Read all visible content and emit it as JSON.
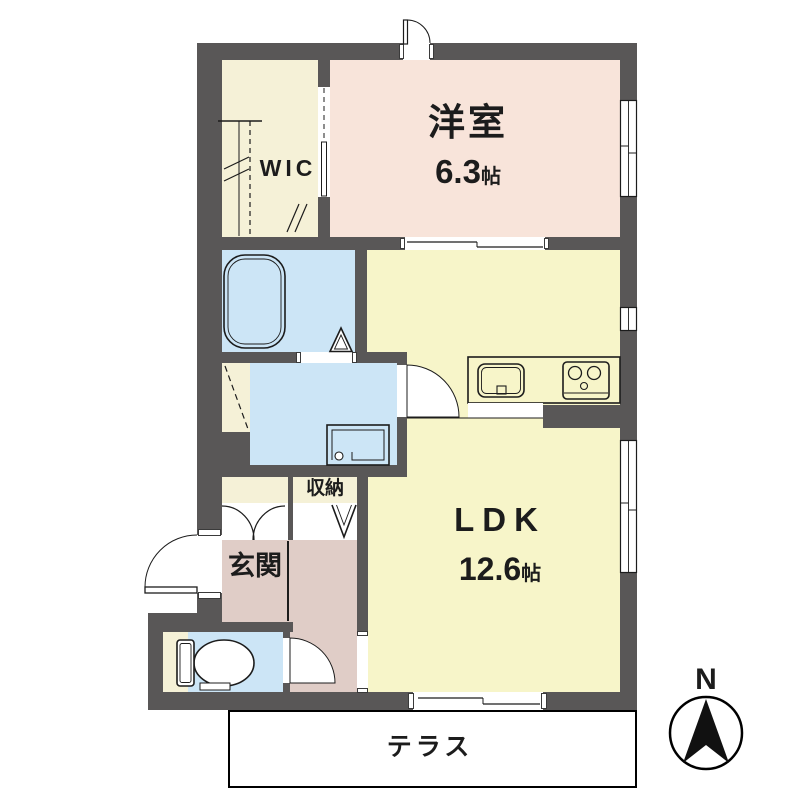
{
  "floorplan": {
    "compass": {
      "label": "N"
    },
    "rooms": {
      "western_room": {
        "name": "洋室",
        "size_value": "6.3",
        "size_unit": "帖"
      },
      "ldk": {
        "name": "LDK",
        "size_value": "12.6",
        "size_unit": "帖"
      },
      "wic": {
        "name": "WIC"
      },
      "entrance": {
        "name": "玄関"
      },
      "storage": {
        "name": "収納"
      },
      "terrace": {
        "name": "テラス"
      }
    },
    "colors": {
      "wall": "#595757",
      "western_room": "#f8e4da",
      "ldk": "#f7f5c9",
      "closet": "#f5f1d7",
      "wet_area": "#cce5f6",
      "entrance_hall": "#e0cdc7",
      "background": "#ffffff",
      "line": "#1c1c1c"
    },
    "icons": {
      "bathtub": "bathtub-icon",
      "toilet": "toilet-icon",
      "washer_pan": "washer-pan-icon",
      "kitchen_sink": "kitchen-sink-icon",
      "gas_stove": "gas-stove-icon",
      "shoe_cabinet": "shoe-cabinet-doors-icon",
      "storage_door": "accordion-door-icon",
      "north_arrow": "north-arrow-icon"
    }
  }
}
